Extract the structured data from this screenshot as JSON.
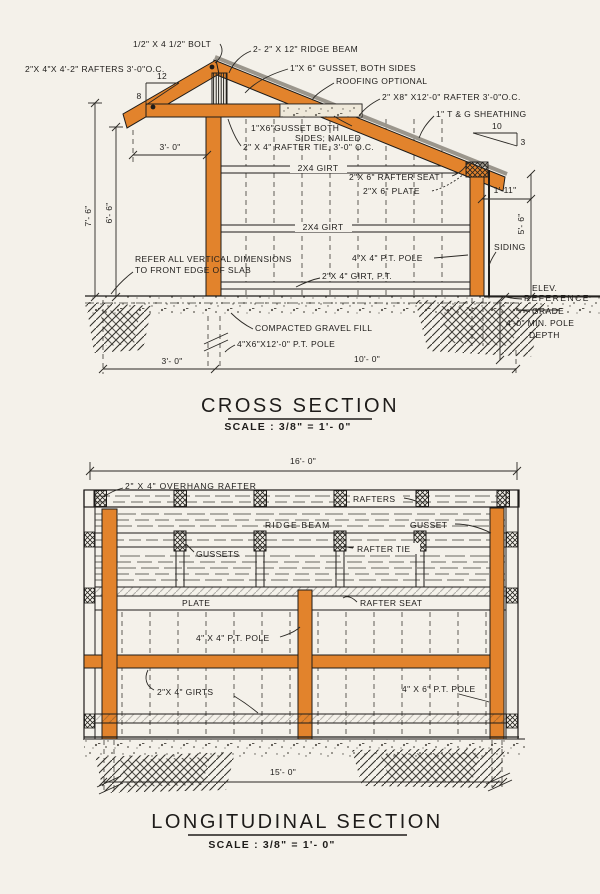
{
  "colors": {
    "wood": "#E2832C",
    "paper": "#F4F1EA",
    "ink": "#1E1C1A"
  },
  "cs": {
    "title": "CROSS SECTION",
    "scale": "SCALE : 3/8\" = 1'- 0\"",
    "labels": {
      "bolt": "1/2\" X 4 1/2\" BOLT",
      "rafters_left": "2\"X 4\"X 4'-2\" RAFTERS 3'-0\"O.C.",
      "ridge_beam": "2- 2\" X 12\" RIDGE BEAM",
      "gusset_both": "1\"X 6\" GUSSET, BOTH SIDES",
      "roofing": "ROOFING OPTIONAL",
      "rafter_right": "2\" X8\" X12'-0\" RAFTER 3'-0\"O.C.",
      "sheathing": "1\" T & G SHEATHING",
      "gusset_nailed1": "1\"X6\"GUSSET BOTH",
      "gusset_nailed2": "SIDES; NAILED",
      "rafter_tie": "2\" X 4\" RAFTER TIE, 3'-0\" O.C.",
      "girt_upper": "2X4 GIRT",
      "rafter_seat": "2\"X 6\" RAFTER SEAT",
      "plate": "2\"X 6\" PLATE",
      "girt_mid": "2X4 GIRT",
      "pole4x4": "4\"X 4\" P.T. POLE",
      "siding": "SIDING",
      "note1": "REFER ALL VERTICAL DIMENSIONS",
      "note2": "TO FRONT EDGE OF SLAB",
      "girt_pt": "2\"X 4\" GIRT, P.T.",
      "elev1": "ELEV.",
      "elev2": "REFERENCE",
      "grade": "GRADE",
      "depth1": "4'-0\" MIN. POLE",
      "depth2": "DEPTH",
      "gravel": "COMPACTED GRAVEL FILL",
      "pole4x6": "4\"X6\"X12'-0\" P.T. POLE"
    },
    "dims": {
      "slope12": "12",
      "slope8": "8",
      "slope10": "10",
      "slope3": "3",
      "top3": "3'- 0\"",
      "h76": "7'- 6\"",
      "h66": "6'- 6\"",
      "off111": "1'-11\"",
      "h56": "5'- 6\"",
      "bot3": "3'- 0\"",
      "bot10": "10'- 0\""
    }
  },
  "ls": {
    "title": "LONGITUDINAL SECTION",
    "scale": "SCALE : 3/8\" = 1'- 0\"",
    "labels": {
      "overhang": "2\" X 4\" OVERHANG RAFTER",
      "rafters": "RAFTERS",
      "ridge_beam": "RIDGE BEAM",
      "gusset": "GUSSET",
      "gussets": "GUSSETS",
      "rafter_tie": "RAFTER TIE",
      "plate": "PLATE",
      "rafter_seat": "RAFTER SEAT",
      "pole4x4": "4\" X 4\" P.T. POLE",
      "girts": "2\"X 4\" GIRTS",
      "pole4x6": "4\" X 6\" P.T. POLE"
    },
    "dims": {
      "top16": "16'- 0\"",
      "bot15": "15'- 0\""
    }
  }
}
